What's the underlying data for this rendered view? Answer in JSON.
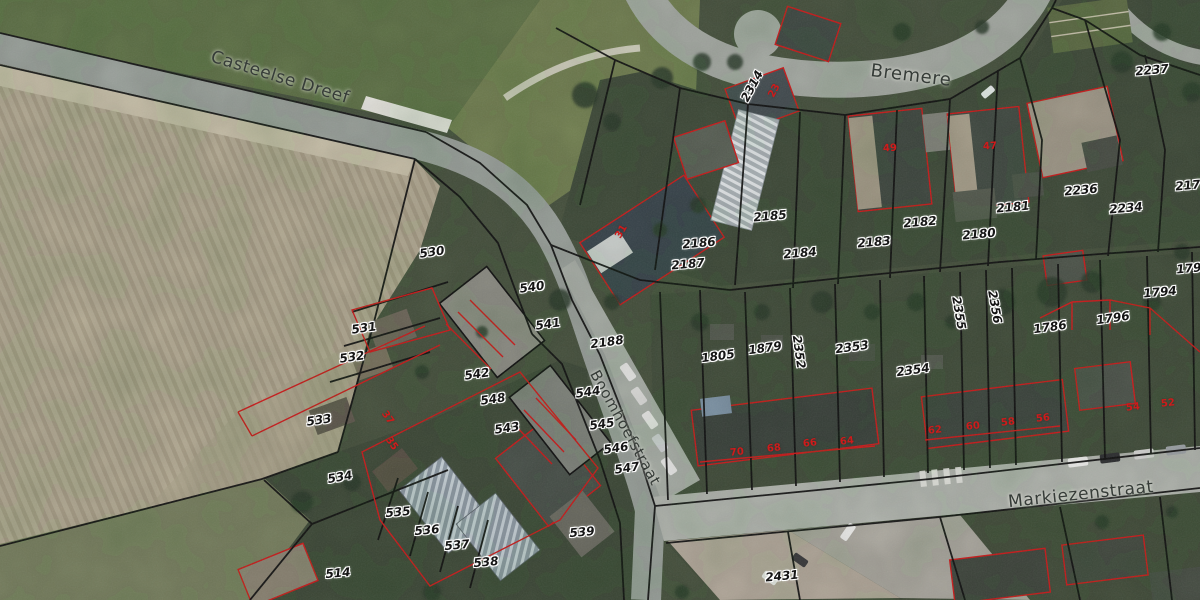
{
  "map": {
    "street_labels": [
      {
        "t": "Casteelse Dreef",
        "x": 280,
        "y": 78,
        "r": 17,
        "size": 17
      },
      {
        "t": "Bremere",
        "x": 911,
        "y": 76,
        "r": 7,
        "size": 18
      },
      {
        "t": "Boomhoefstraat",
        "x": 625,
        "y": 428,
        "r": 61,
        "size": 15
      },
      {
        "t": "Markiezenstraat",
        "x": 1081,
        "y": 495,
        "r": -6,
        "size": 17
      }
    ],
    "parcel_labels": [
      {
        "t": "530",
        "x": 432,
        "y": 252,
        "r": -8
      },
      {
        "t": "540",
        "x": 532,
        "y": 287,
        "r": -8
      },
      {
        "t": "541",
        "x": 548,
        "y": 324,
        "r": -8
      },
      {
        "t": "2188",
        "x": 607,
        "y": 342,
        "r": -8
      },
      {
        "t": "531",
        "x": 364,
        "y": 328,
        "r": -8
      },
      {
        "t": "532",
        "x": 352,
        "y": 357,
        "r": -8
      },
      {
        "t": "533",
        "x": 319,
        "y": 420,
        "r": -8
      },
      {
        "t": "534",
        "x": 340,
        "y": 477,
        "r": -10
      },
      {
        "t": "535",
        "x": 398,
        "y": 512,
        "r": -5
      },
      {
        "t": "536",
        "x": 427,
        "y": 530,
        "r": -5
      },
      {
        "t": "537",
        "x": 457,
        "y": 545,
        "r": -5
      },
      {
        "t": "538",
        "x": 486,
        "y": 562,
        "r": -5
      },
      {
        "t": "539",
        "x": 582,
        "y": 532,
        "r": -5
      },
      {
        "t": "514",
        "x": 338,
        "y": 573,
        "r": -5
      },
      {
        "t": "542",
        "x": 477,
        "y": 374,
        "r": -8
      },
      {
        "t": "548",
        "x": 493,
        "y": 399,
        "r": -8
      },
      {
        "t": "543",
        "x": 507,
        "y": 428,
        "r": -8
      },
      {
        "t": "544",
        "x": 588,
        "y": 392,
        "r": -8
      },
      {
        "t": "545",
        "x": 602,
        "y": 424,
        "r": -8
      },
      {
        "t": "546",
        "x": 616,
        "y": 448,
        "r": -8
      },
      {
        "t": "547",
        "x": 627,
        "y": 468,
        "r": -8
      },
      {
        "t": "2314",
        "x": 752,
        "y": 86,
        "r": -62
      },
      {
        "t": "2186",
        "x": 699,
        "y": 243,
        "r": -5
      },
      {
        "t": "2187",
        "x": 688,
        "y": 264,
        "r": -5
      },
      {
        "t": "2185",
        "x": 770,
        "y": 216,
        "r": -5
      },
      {
        "t": "2184",
        "x": 800,
        "y": 253,
        "r": -5
      },
      {
        "t": "2183",
        "x": 874,
        "y": 242,
        "r": -5
      },
      {
        "t": "2182",
        "x": 920,
        "y": 222,
        "r": -5
      },
      {
        "t": "2181",
        "x": 1013,
        "y": 207,
        "r": -5
      },
      {
        "t": "2180",
        "x": 979,
        "y": 234,
        "r": -5
      },
      {
        "t": "2237",
        "x": 1152,
        "y": 70,
        "r": -5
      },
      {
        "t": "2236",
        "x": 1081,
        "y": 190,
        "r": -5
      },
      {
        "t": "2234",
        "x": 1126,
        "y": 208,
        "r": -5
      },
      {
        "t": "2179",
        "x": 1192,
        "y": 185,
        "r": -5
      },
      {
        "t": "1795",
        "x": 1193,
        "y": 268,
        "r": -5
      },
      {
        "t": "1794",
        "x": 1160,
        "y": 292,
        "r": -5
      },
      {
        "t": "1796",
        "x": 1113,
        "y": 318,
        "r": -8
      },
      {
        "t": "1786",
        "x": 1050,
        "y": 327,
        "r": -8
      },
      {
        "t": "2355",
        "x": 959,
        "y": 313,
        "r": 80
      },
      {
        "t": "2356",
        "x": 995,
        "y": 307,
        "r": 80
      },
      {
        "t": "1805",
        "x": 718,
        "y": 356,
        "r": -8
      },
      {
        "t": "1879",
        "x": 765,
        "y": 348,
        "r": -8
      },
      {
        "t": "2352",
        "x": 799,
        "y": 352,
        "r": 82
      },
      {
        "t": "2353",
        "x": 852,
        "y": 347,
        "r": -8
      },
      {
        "t": "2354",
        "x": 913,
        "y": 370,
        "r": -8
      },
      {
        "t": "2431",
        "x": 782,
        "y": 576,
        "r": -5
      }
    ],
    "house_number_labels": [
      {
        "t": "49",
        "x": 890,
        "y": 149,
        "r": -3
      },
      {
        "t": "47",
        "x": 990,
        "y": 147,
        "r": -3
      },
      {
        "t": "31",
        "x": 622,
        "y": 232,
        "r": -60
      },
      {
        "t": "23",
        "x": 775,
        "y": 91,
        "r": -62
      },
      {
        "t": "37",
        "x": 387,
        "y": 418,
        "r": 55
      },
      {
        "t": "35",
        "x": 391,
        "y": 444,
        "r": 55
      },
      {
        "t": "70",
        "x": 737,
        "y": 453,
        "r": -6
      },
      {
        "t": "68",
        "x": 774,
        "y": 449,
        "r": -6
      },
      {
        "t": "66",
        "x": 810,
        "y": 444,
        "r": -6
      },
      {
        "t": "64",
        "x": 847,
        "y": 442,
        "r": -6
      },
      {
        "t": "62",
        "x": 935,
        "y": 431,
        "r": -6
      },
      {
        "t": "60",
        "x": 973,
        "y": 427,
        "r": -6
      },
      {
        "t": "58",
        "x": 1008,
        "y": 423,
        "r": -6
      },
      {
        "t": "56",
        "x": 1043,
        "y": 419,
        "r": -6
      },
      {
        "t": "54",
        "x": 1133,
        "y": 408,
        "r": -6
      },
      {
        "t": "52",
        "x": 1168,
        "y": 404,
        "r": -6
      }
    ],
    "colors": {
      "parcel_line": "#101010",
      "building_outline": "#cf1b1b",
      "field": "#b4ab94",
      "road": "#9aa19b",
      "label_halo": "#ffffff"
    }
  }
}
